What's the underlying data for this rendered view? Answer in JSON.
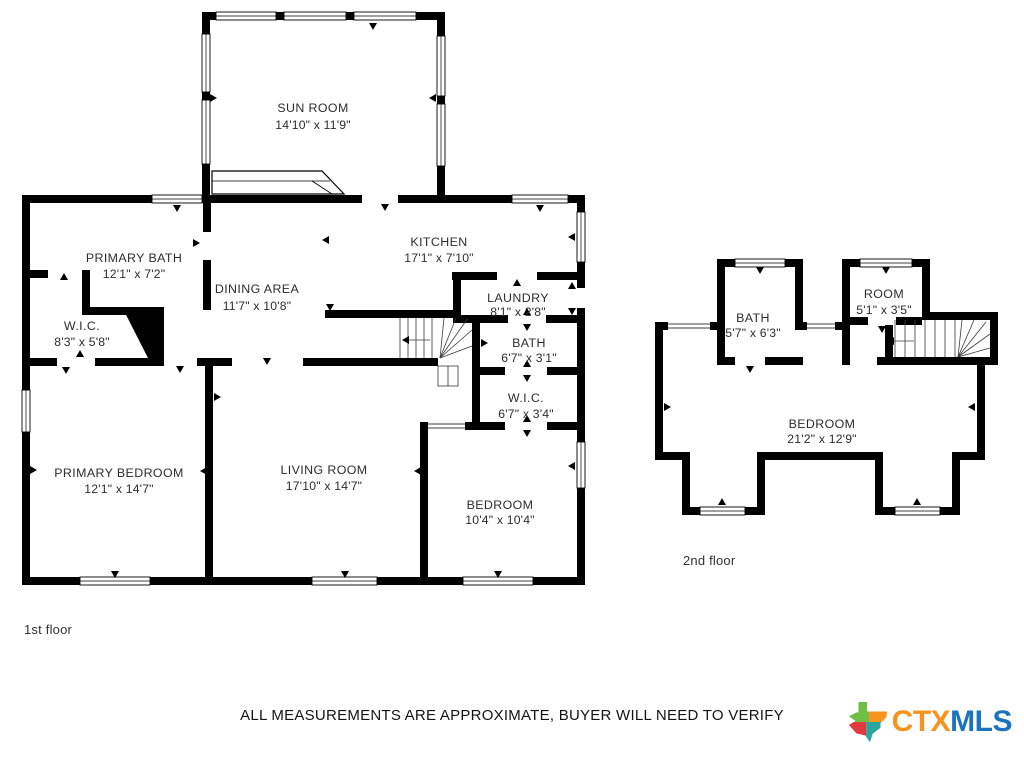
{
  "floor1": {
    "label": "1st floor",
    "rooms": [
      {
        "name": "SUN ROOM",
        "dims": "14'10\" x 11'9\""
      },
      {
        "name": "PRIMARY BATH",
        "dims": "12'1\" x 7'2\""
      },
      {
        "name": "KITCHEN",
        "dims": "17'1\" x 7'10\""
      },
      {
        "name": "DINING AREA",
        "dims": "11'7\" x 10'8\""
      },
      {
        "name": "LAUNDRY",
        "dims": "8'1\" x 2'8\""
      },
      {
        "name": "W.I.C.",
        "dims": "8'3\" x 5'8\""
      },
      {
        "name": "BATH",
        "dims": "6'7\" x 3'1\""
      },
      {
        "name": "W.I.C.",
        "dims": "6'7\" x 3'4\""
      },
      {
        "name": "PRIMARY BEDROOM",
        "dims": "12'1\" x 14'7\""
      },
      {
        "name": "LIVING ROOM",
        "dims": "17'10\" x 14'7\""
      },
      {
        "name": "BEDROOM",
        "dims": "10'4\" x 10'4\""
      }
    ]
  },
  "floor2": {
    "label": "2nd floor",
    "rooms": [
      {
        "name": "BATH",
        "dims": "5'7\" x 6'3\""
      },
      {
        "name": "ROOM",
        "dims": "5'1\" x 3'5\""
      },
      {
        "name": "BEDROOM",
        "dims": "21'2\" x 12'9\""
      }
    ]
  },
  "disclaimer": "ALL MEASUREMENTS ARE APPROXIMATE, BUYER WILL NEED TO VERIFY",
  "logo": {
    "ctx": "CTX",
    "mls": "MLS",
    "color_ctx": "#F7941E",
    "color_mls": "#1C75BC"
  }
}
